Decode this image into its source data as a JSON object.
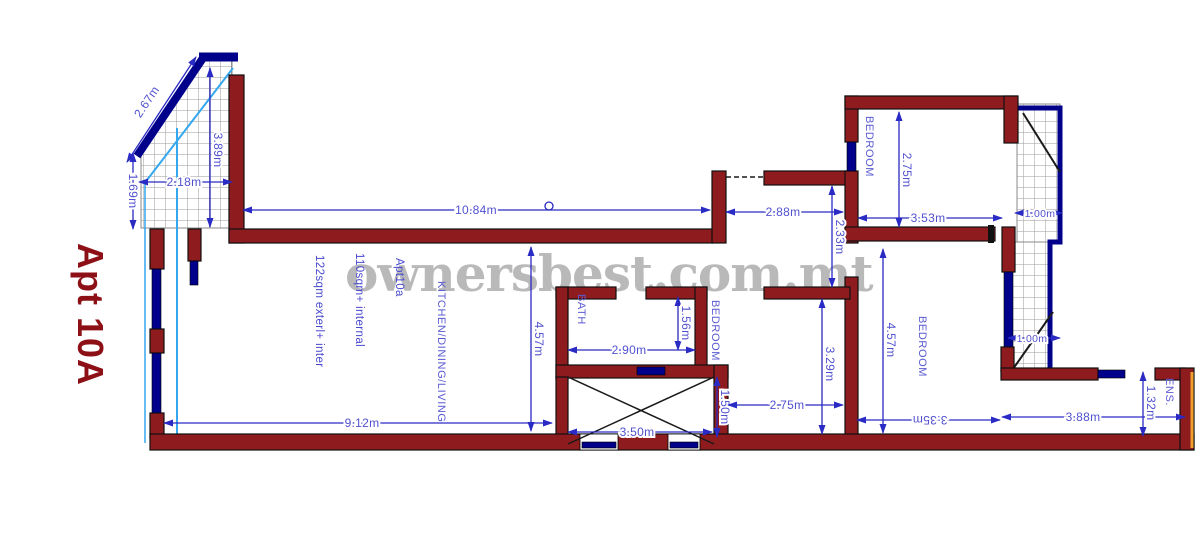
{
  "title": "Apt 10A",
  "watermark": "ownersbest.com.mt",
  "colors": {
    "wall": "#8e1b1e",
    "dimension_line": "#2a2ac4",
    "dimension_text": "#5151d0",
    "glazing": "#00008b",
    "terrace_guide": "#35a7ee",
    "hatch_grid": "#9a9a9a",
    "watermark": "#b4b4b4",
    "title": "#8c1016",
    "right_edge_accent": "#f0a030"
  },
  "labels": {
    "kitchen": "KITCHEN/DINING/LIVING",
    "bath": "BATH",
    "bedroom_mid": "BEDROOM",
    "bedroom_top": "BEDROOM",
    "bedroom_right": "BEDROOM",
    "ensuite": "ENS.",
    "area_note_1": "122sqm exterl+ inter",
    "area_note_2": "110sqm+ internal",
    "area_note_3": "Apt10a"
  },
  "dimensions": {
    "terrace_diagonal": "2.67m",
    "terrace_height": "3.89m",
    "terrace_width": "2.18m",
    "terrace_side": "1.69m",
    "living_top": "10.84m",
    "living_height": "4.57m",
    "living_bottom": "9.12m",
    "bath_width": "2.90m",
    "bath_depth": "1.56m",
    "shaft_width": "3.50m",
    "shaft_depth": "1.50m",
    "hall_width": "2.88m",
    "hall_depth": "2.33m",
    "bedroom_mid_depth": "3.29m",
    "bedroom_mid_width": "2.75m",
    "bedroom_top_depth": "2.75m",
    "bedroom_top_width": "3.53m",
    "balcony_top_width": "1.00m",
    "balcony_mid_width": "1.00m",
    "bedroom_right_depth": "4.57m",
    "bedroom_right_width": "3.35m",
    "ens_width": "3.88m",
    "ens_depth": "1.32m"
  }
}
